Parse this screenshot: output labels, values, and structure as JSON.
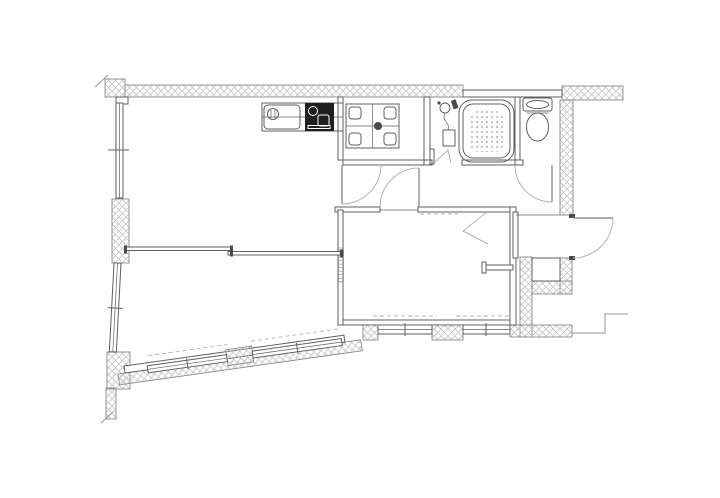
{
  "document": {
    "type": "architectural-floor-plan",
    "description": "Black-and-white apartment floor plan line drawing with cross-hatched exterior walls, no text labels or dimensions visible",
    "text_labels": []
  },
  "colors": {
    "background": "#ffffff",
    "line": "#5f5f5f",
    "wall_border": "#8a8a8a",
    "wall_hatch": "#c8c8c8",
    "door_arc": "#b3b3b3",
    "fixture_dark": "#1f1f1f",
    "exterior_line": "#9a9a9a"
  },
  "rooms": [
    {
      "name": "living-dining-kitchen",
      "position": "upper-left"
    },
    {
      "name": "bedroom-southwest",
      "position": "lower-left",
      "note": "angled outer wall with stepped windows"
    },
    {
      "name": "bedroom-southeast",
      "position": "lower-middle",
      "note": "closet chevron symbol, two windows"
    },
    {
      "name": "laundry-washroom",
      "position": "top-middle"
    },
    {
      "name": "bathroom",
      "position": "top-right",
      "note": "bathtub with anti-slip dot pattern and shower"
    },
    {
      "name": "toilet-room",
      "position": "top-right corner"
    },
    {
      "name": "entrance-genkan",
      "position": "right side",
      "note": "door swings outward"
    }
  ],
  "fixtures": [
    "kitchen-counter",
    "kitchen-sink",
    "gas-stove",
    "washing-machine-pan",
    "bathtub",
    "shower-head",
    "toilet",
    "meter-box-niche"
  ]
}
